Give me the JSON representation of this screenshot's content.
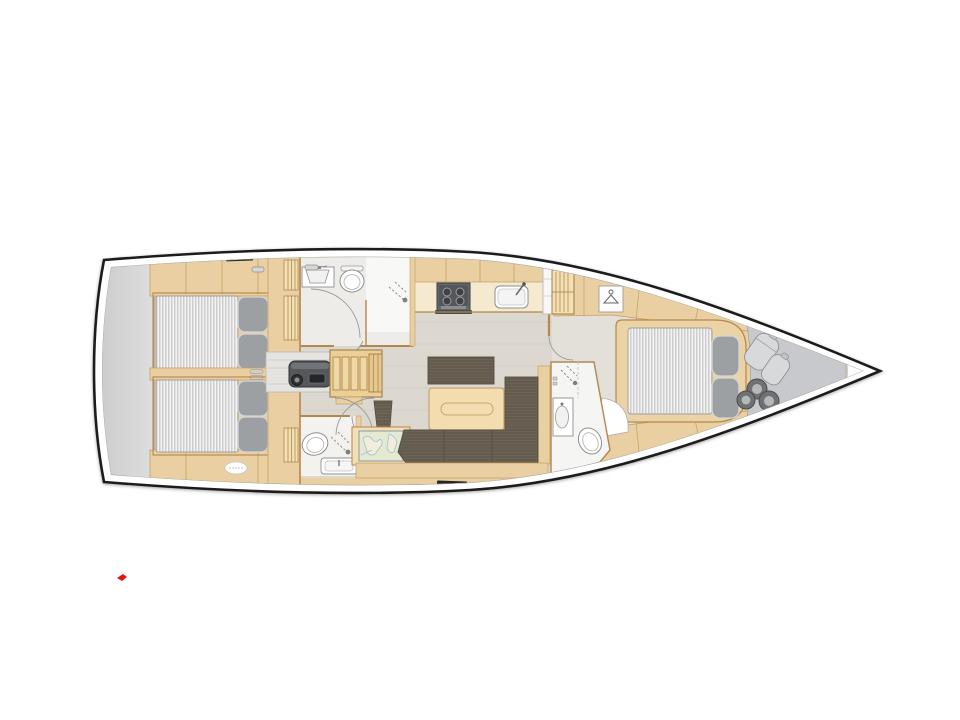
{
  "image": {
    "kind": "yacht-interior-floorplan-top-view",
    "bow_direction": "right",
    "background": "#ffffff"
  },
  "colors": {
    "hull-outline": "#1e1e1e",
    "inner-line": "#a9a9a9",
    "wood": "#e9cfa1",
    "wood-light": "#f2dfb4",
    "counter": "#f5ead0",
    "wood-trim": "#b3874d",
    "wood-seam": "#c79f63",
    "floor-salon": "#dcd8cf",
    "floor-grain": "#c9c4b8",
    "floor-fwd": "#e3e0d9",
    "bath-floor": "#edece8",
    "shower-white": "#f8f8f6",
    "fixture-outline": "#8f8f8f",
    "door-arc": "#9a9a9a",
    "mattress": "#f3f3f3",
    "mattress-stripe": "#c4c4c4",
    "pillow": "#9da0a2",
    "pillow-edge": "#d6d6d6",
    "sofa": "#6c6355",
    "sofa-line": "#565043",
    "table": "#f3ddb0",
    "table-edge": "#c8a670",
    "engine": "#55585b",
    "engine-dark": "#2f3133",
    "stern-platform-light": "#dedede",
    "stern-platform-dark": "#cccccc",
    "bow-storage": "#c7c9cd",
    "bag": "#d8d9db",
    "fender": "#6f7174",
    "fender-core": "#b7b8ba",
    "hatch": "#242424",
    "map-bg": "#e4e9d2",
    "map-land": "#f1edda",
    "map-water": "#9fc0d4",
    "red-mark": "#e51414"
  },
  "icons": [
    {
      "name": "shower-icon",
      "glyph": "dashed-spray-lines-with-dot"
    },
    {
      "name": "hanger-icon",
      "glyph": "clothes-hanger"
    },
    {
      "name": "stove-icon",
      "glyph": "four-burner-circles"
    },
    {
      "name": "faucet-icon",
      "glyph": "angled-tap"
    }
  ]
}
